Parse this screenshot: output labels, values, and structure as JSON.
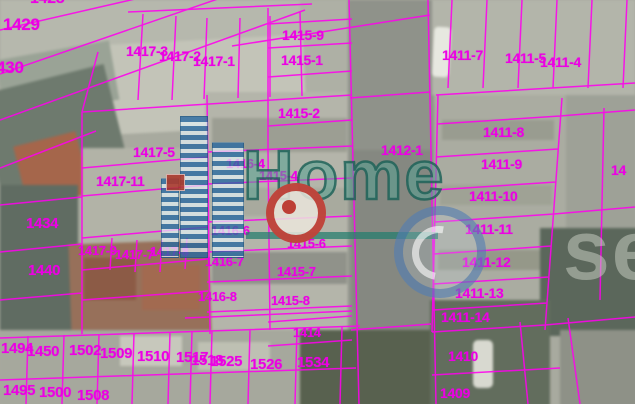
{
  "map": {
    "parcel_line_color": "#ff00ee",
    "parcel_label_color": "#ec00e4",
    "parcel_labels": [
      {
        "text": "1428",
        "x": 30,
        "y": -9,
        "size": 16
      },
      {
        "text": "1429",
        "x": 3,
        "y": 16,
        "size": 17
      },
      {
        "text": "1430",
        "x": -13,
        "y": 59,
        "size": 17
      },
      {
        "text": "1417-3",
        "x": 126,
        "y": 44,
        "size": 14
      },
      {
        "text": "1417-2",
        "x": 159,
        "y": 49,
        "size": 14
      },
      {
        "text": "1417-1",
        "x": 193,
        "y": 54,
        "size": 14
      },
      {
        "text": "1415-9",
        "x": 282,
        "y": 28,
        "size": 14
      },
      {
        "text": "1415-1",
        "x": 281,
        "y": 53,
        "size": 14
      },
      {
        "text": "1415-2",
        "x": 278,
        "y": 106,
        "size": 14
      },
      {
        "text": "1417-5",
        "x": 133,
        "y": 145,
        "size": 14
      },
      {
        "text": "1417-11",
        "x": 96,
        "y": 174,
        "size": 14
      },
      {
        "text": "1434",
        "x": 26,
        "y": 216,
        "size": 15
      },
      {
        "text": "1440",
        "x": 28,
        "y": 263,
        "size": 15
      },
      {
        "text": "1417-9",
        "x": 78,
        "y": 244,
        "size": 13
      },
      {
        "text": "1417-7",
        "x": 115,
        "y": 248,
        "size": 13
      },
      {
        "text": "1417-8",
        "x": 150,
        "y": 245,
        "size": 13
      },
      {
        "text": "1416-4",
        "x": 226,
        "y": 157,
        "size": 13
      },
      {
        "text": "1415-4",
        "x": 259,
        "y": 169,
        "size": 13
      },
      {
        "text": "1412-1",
        "x": 381,
        "y": 143,
        "size": 14
      },
      {
        "text": "1416-6",
        "x": 211,
        "y": 224,
        "size": 13
      },
      {
        "text": "1415-6",
        "x": 287,
        "y": 237,
        "size": 13
      },
      {
        "text": "1416-7",
        "x": 205,
        "y": 255,
        "size": 13
      },
      {
        "text": "1415-7",
        "x": 277,
        "y": 265,
        "size": 13
      },
      {
        "text": "1416-8",
        "x": 198,
        "y": 290,
        "size": 13
      },
      {
        "text": "1415-8",
        "x": 271,
        "y": 294,
        "size": 13
      },
      {
        "text": "1414",
        "x": 293,
        "y": 326,
        "size": 13
      },
      {
        "text": "1411-7",
        "x": 442,
        "y": 48,
        "size": 14
      },
      {
        "text": "1411-5",
        "x": 505,
        "y": 51,
        "size": 14
      },
      {
        "text": "1411-4",
        "x": 540,
        "y": 55,
        "size": 14
      },
      {
        "text": "1411-8",
        "x": 483,
        "y": 125,
        "size": 14
      },
      {
        "text": "1411-9",
        "x": 481,
        "y": 157,
        "size": 14
      },
      {
        "text": "1411-10",
        "x": 469,
        "y": 189,
        "size": 14
      },
      {
        "text": "1411-11",
        "x": 465,
        "y": 222,
        "size": 14
      },
      {
        "text": "1411-12",
        "x": 462,
        "y": 255,
        "size": 14
      },
      {
        "text": "1411-13",
        "x": 455,
        "y": 286,
        "size": 14
      },
      {
        "text": "1411-14",
        "x": 441,
        "y": 310,
        "size": 14
      },
      {
        "text": "1410",
        "x": 448,
        "y": 349,
        "size": 14
      },
      {
        "text": "1409",
        "x": 440,
        "y": 386,
        "size": 14
      },
      {
        "text": "14",
        "x": 611,
        "y": 163,
        "size": 14
      },
      {
        "text": "1494",
        "x": 1,
        "y": 341,
        "size": 15
      },
      {
        "text": "1450",
        "x": 27,
        "y": 344,
        "size": 15
      },
      {
        "text": "1502",
        "x": 69,
        "y": 343,
        "size": 15
      },
      {
        "text": "1509",
        "x": 100,
        "y": 346,
        "size": 15
      },
      {
        "text": "1510",
        "x": 137,
        "y": 349,
        "size": 15
      },
      {
        "text": "1517",
        "x": 176,
        "y": 350,
        "size": 15
      },
      {
        "text": "1518",
        "x": 191,
        "y": 353,
        "size": 15
      },
      {
        "text": "1525",
        "x": 210,
        "y": 354,
        "size": 15
      },
      {
        "text": "1526",
        "x": 250,
        "y": 357,
        "size": 15
      },
      {
        "text": "1534",
        "x": 297,
        "y": 355,
        "size": 15
      },
      {
        "text": "1495",
        "x": 3,
        "y": 383,
        "size": 15
      },
      {
        "text": "1500",
        "x": 39,
        "y": 385,
        "size": 15
      },
      {
        "text": "1508",
        "x": 77,
        "y": 388,
        "size": 15
      }
    ]
  },
  "watermark": {
    "brand_text": "Home",
    "partial_text_right": "se",
    "brand_color": "#2f9b8a",
    "building_icon_color": "#2869a0",
    "badge_ring_color": "#b92d23",
    "swirl_color": "#376aaa"
  }
}
